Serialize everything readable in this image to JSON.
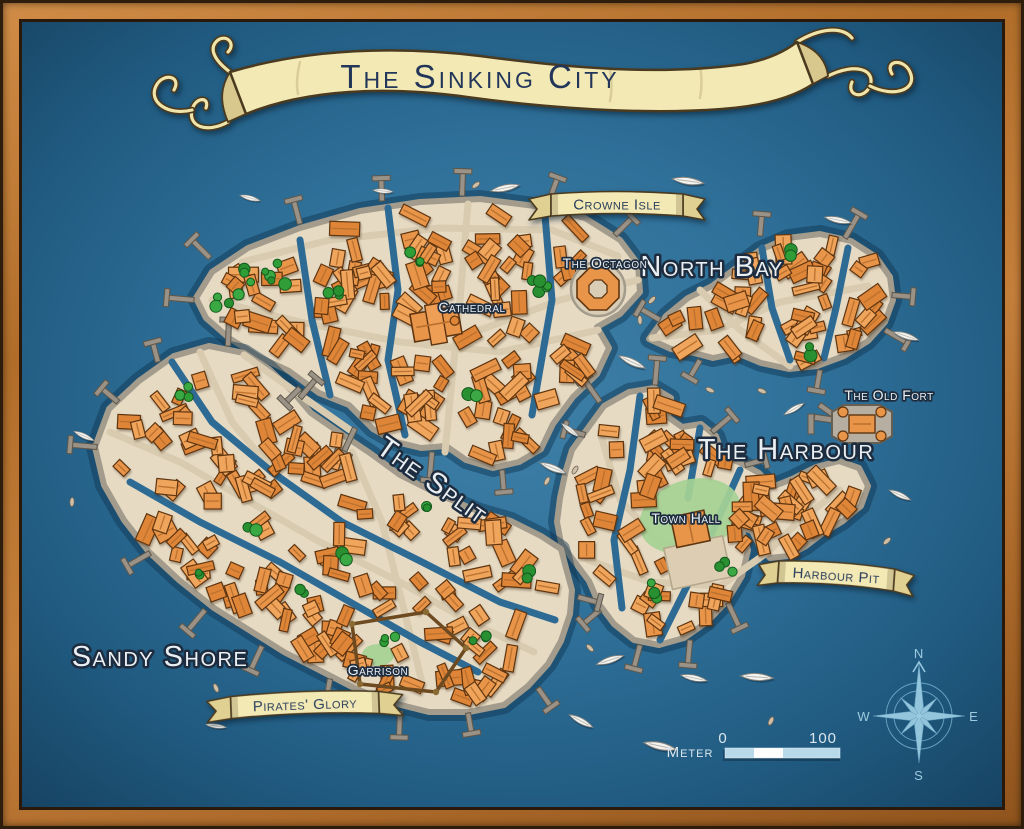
{
  "title": "The Sinking City",
  "banners": {
    "crowne_isle": "Crowne Isle",
    "harbour_pit": "Harbour Pit",
    "pirates_glory": "Pirates' Glory"
  },
  "districts": {
    "north_bay": "North Bay",
    "the_octagon": "The Octagon",
    "cathedral": "Cathedral",
    "the_old_fort": "The Old Fort",
    "the_harbour": "The Harbour",
    "the_split": "The Split",
    "town_hall": "Town Hall",
    "sandy_shore": "Sandy Shore",
    "garrison": "Garrison"
  },
  "compass": {
    "n": "N",
    "e": "E",
    "s": "S",
    "w": "W"
  },
  "scale": {
    "label": "Meter",
    "start": "0",
    "end": "100"
  },
  "colors": {
    "water_deep": "#15425f",
    "water_mid": "#2e6b94",
    "water_light": "#3f80a8",
    "island_sand": "#e6dac3",
    "island_rim": "#a39b8c",
    "street": "#d8cbb0",
    "building": "#e8954a",
    "building_light": "#f0a55c",
    "building_dark": "#df8538",
    "building_stroke": "#5f3510",
    "ridge": "#b9702e",
    "tree": "#2f9e36",
    "tree_dark": "#289030",
    "tree_light": "#3aa843",
    "tree_stroke": "#14591d",
    "park": "#a6d295",
    "dock": "#9a9286",
    "dock_stroke": "#5e5649",
    "boat_hull": "#f3f3f0",
    "rowboat": "#cdbfa8",
    "ribbon_cream": "#f2e9b4",
    "ribbon_shade": "#d9c88d",
    "banner_text_navy": "#2b3e5e",
    "label_white": "#eaeff3",
    "label_outline": "#1d2c3e",
    "compass_blue": "#a5d6ea",
    "scale_blue": "#b8d9ea",
    "frame_wood": "#bd7a36"
  }
}
